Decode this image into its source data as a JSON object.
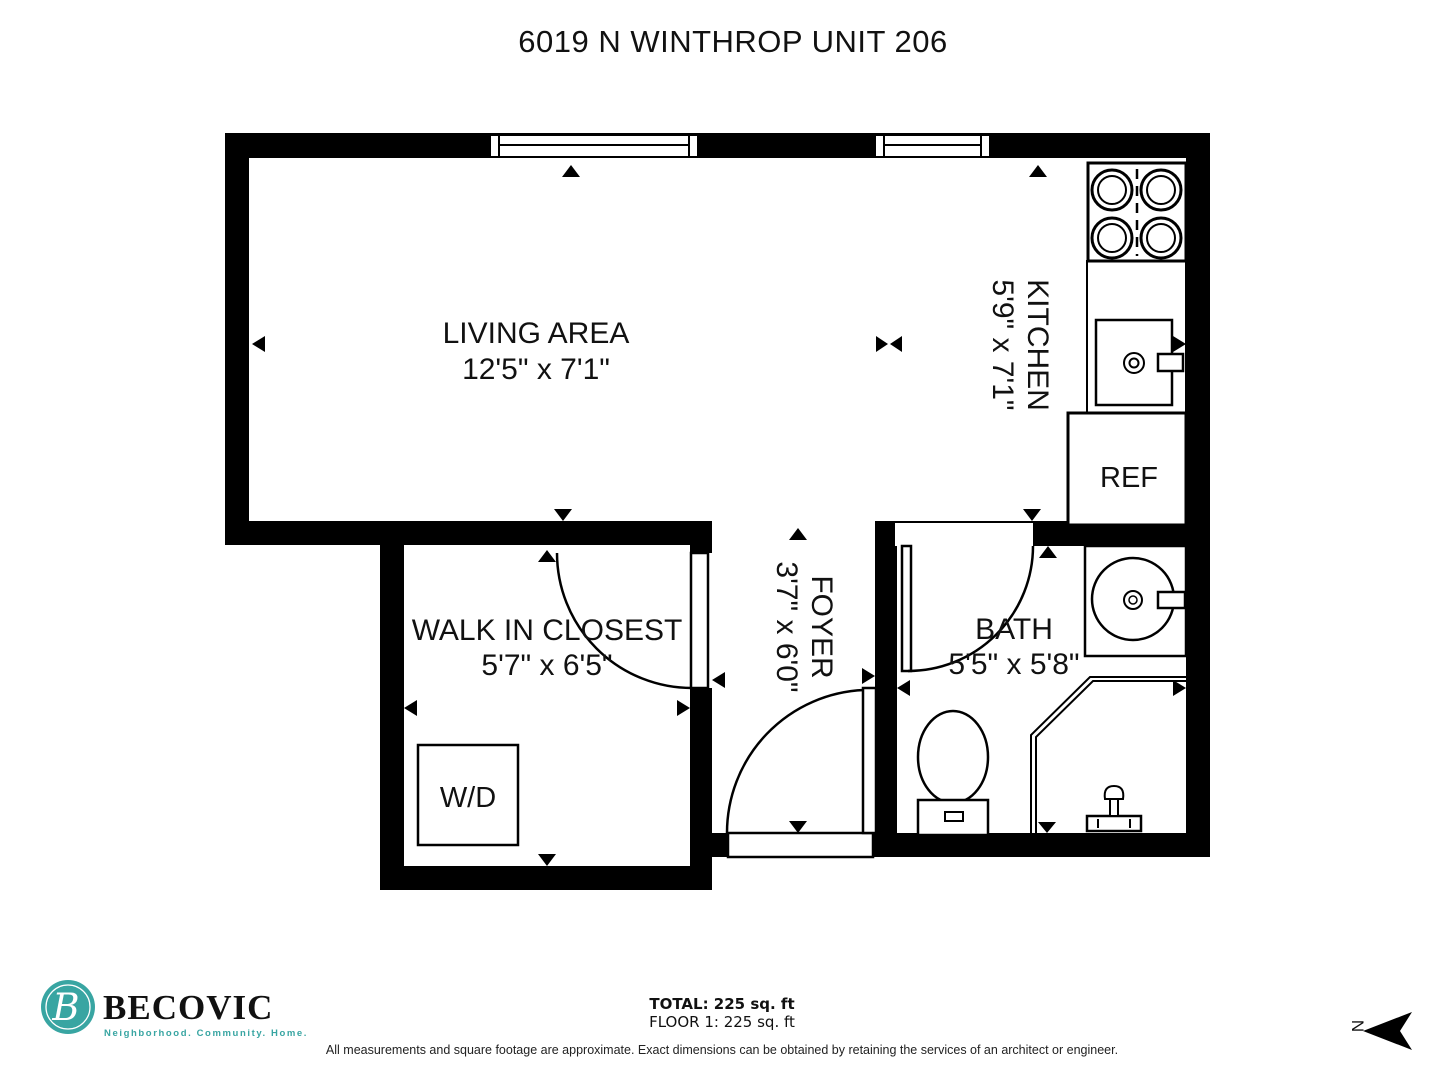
{
  "title": "6019 N WINTHROP UNIT 206",
  "rooms": {
    "living": {
      "name": "LIVING AREA",
      "dims": "12'5\" x 7'1\""
    },
    "kitchen": {
      "name": "KITCHEN",
      "dims": "5'9\" x 7'1\""
    },
    "closet": {
      "name": "WALK IN CLOSEST",
      "dims": "5'7\" x 6'5\""
    },
    "foyer": {
      "name": "FOYER",
      "dims": "3'7\" x 6'0\""
    },
    "bath": {
      "name": "BATH",
      "dims": "5'5\" x 5'8\""
    }
  },
  "fixtures": {
    "refrigerator": "REF",
    "washer_dryer": "W/D"
  },
  "footer": {
    "brand": "BECOVIC",
    "brand_initial": "B",
    "tagline": "Neighborhood. Community. Home.",
    "total": "TOTAL: 225 sq. ft",
    "floor": "FLOOR 1: 225 sq. ft",
    "disclaimer": "All measurements and square footage are approximate. Exact dimensions can be obtained by retaining the services of an architect or engineer.",
    "north": "N"
  },
  "colors": {
    "brand_teal": "#38A5A2",
    "line": "#000000"
  }
}
